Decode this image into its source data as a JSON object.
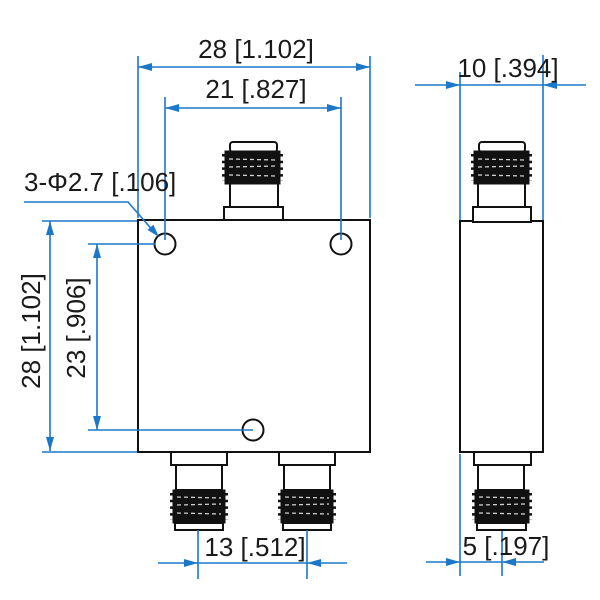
{
  "colors": {
    "dimension_blue": "#1b78c9",
    "geometry_black": "#111111",
    "background": "#ffffff"
  },
  "labels": {
    "dim_body_width": "28 [1.102]",
    "dim_hole_span_h": "21 [.827]",
    "dim_side_width": "10 [.394]",
    "callout_holes": "3-Φ2.7 [.106]",
    "dim_body_height": "28 [1.102]",
    "dim_hole_span_v": "23 [.906]",
    "dim_port_spacing": "13 [.512]",
    "dim_side_offset": "5 [.197]"
  }
}
